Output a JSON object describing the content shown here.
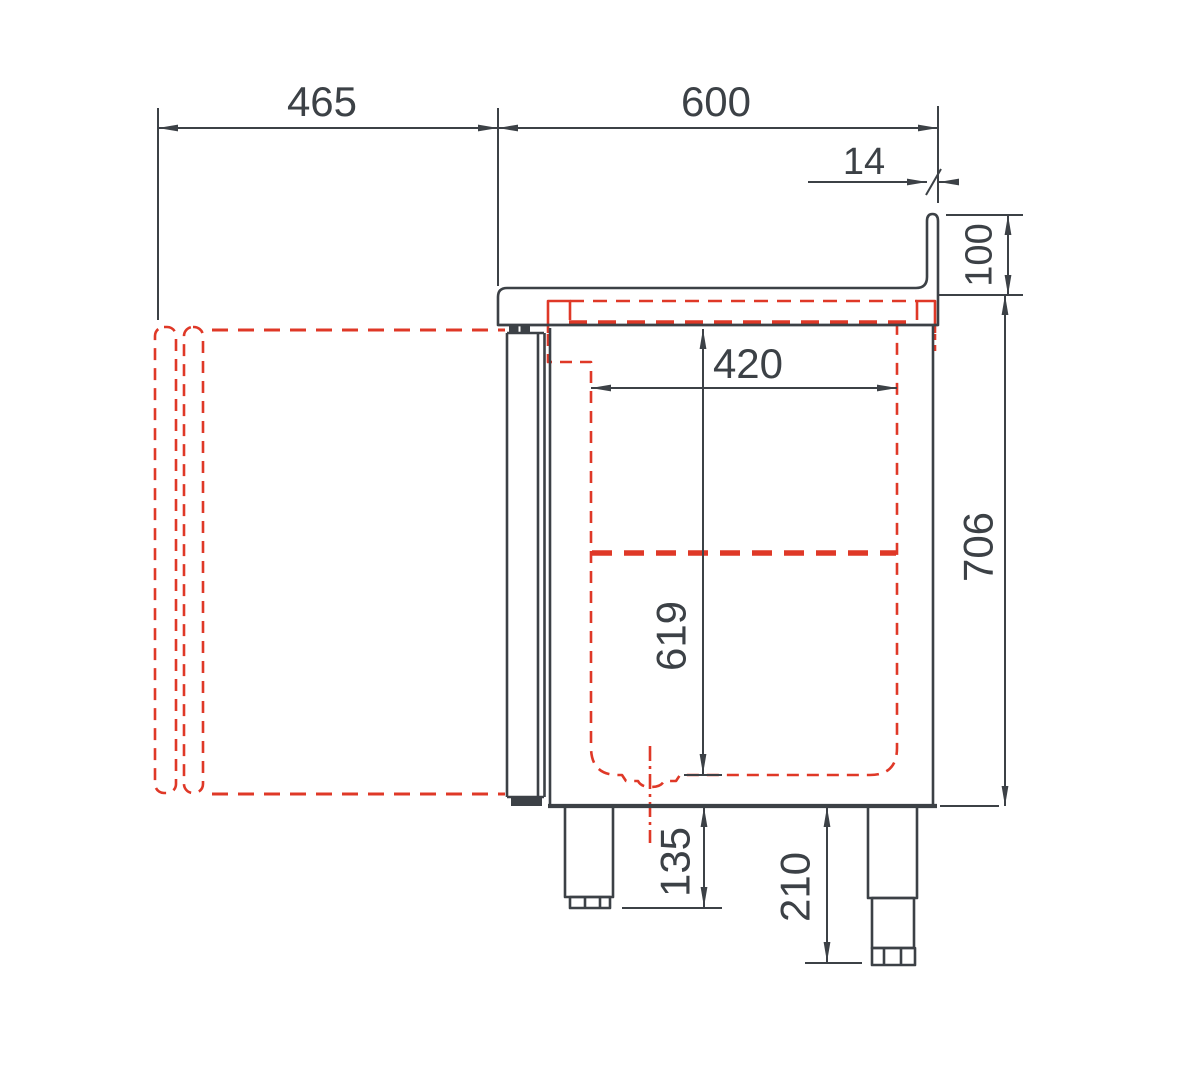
{
  "drawing": {
    "type": "technical-section-side-view",
    "colors": {
      "line": "#3c4146",
      "phantom_red": "#df3827",
      "background": "#ffffff"
    },
    "dimensions": {
      "front_clearance": "465",
      "overall_depth": "600",
      "splashback_thickness": "14",
      "splashback_height": "100",
      "interior_depth": "420",
      "body_height": "706",
      "interior_height": "619",
      "foot_height_front": "135",
      "foot_height_rear": "210"
    }
  }
}
